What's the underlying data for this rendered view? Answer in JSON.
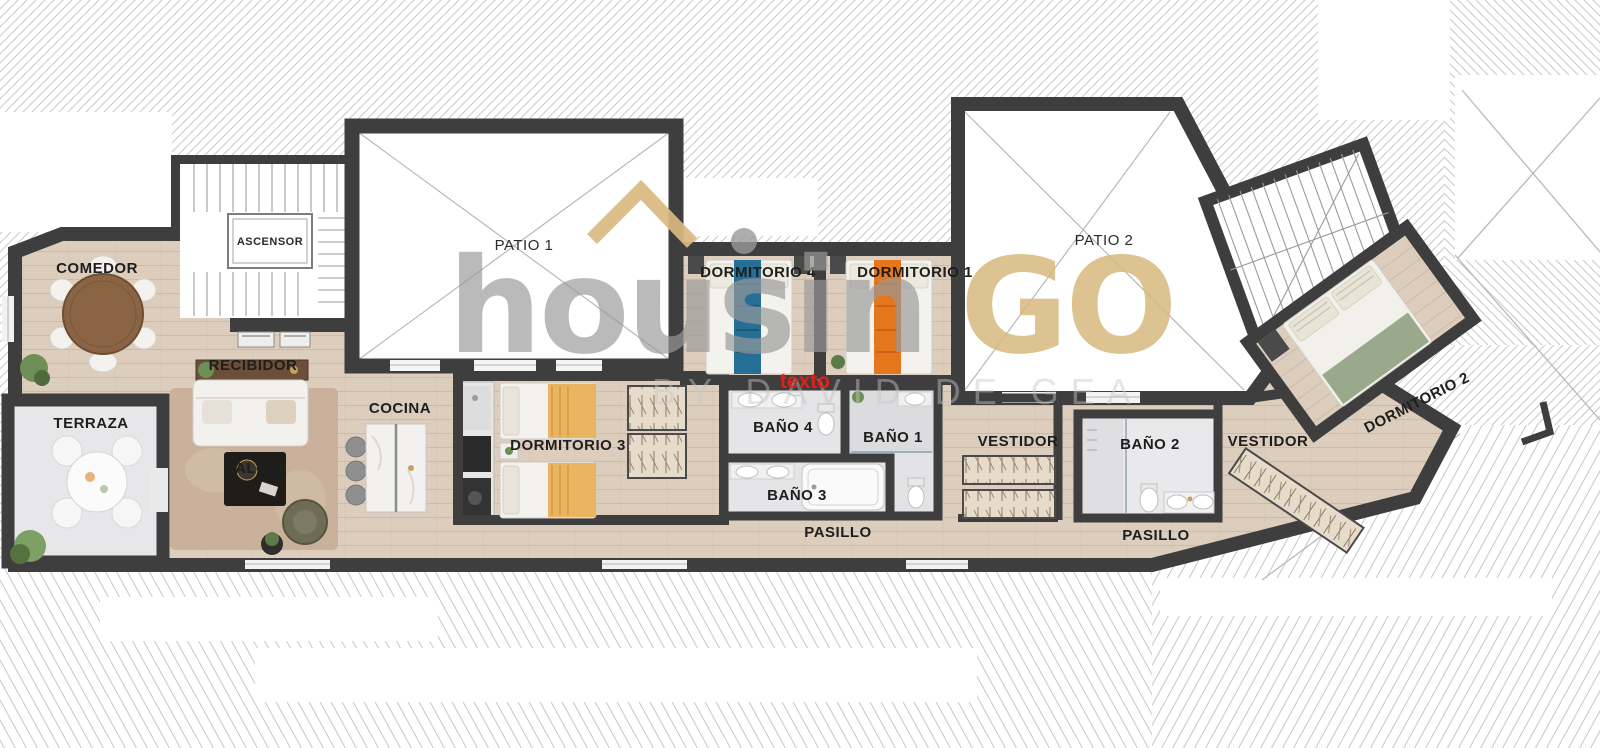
{
  "watermark": {
    "brand_gray": "housin",
    "brand_gold": "GO",
    "tagline": "BY DAVID DE GEA",
    "placeholder": "texto",
    "roof_icon": "gold house-roof chevron with gray dot"
  },
  "colors": {
    "brand_gold": "#d8b87f",
    "brand_gray": "#9a9a9a",
    "tagline_gray": "#c6c6c6",
    "placeholder_red": "#e5211a",
    "wall_dark": "#3e3e3e",
    "wood_floor": "#dccdbc",
    "terrace_floor": "#e7e7e9",
    "bath_floor": "#e5e5e7",
    "accent_blue": "#256e96",
    "accent_orange": "#e4761c",
    "accent_sage": "#9aa98c"
  },
  "rooms": {
    "comedor": "COMEDOR",
    "ascensor": "ASCENSOR",
    "patio_1": "PATIO 1",
    "dormitorio_4": "DORMITORIO 4",
    "dormitorio_1": "DORMITORIO 1",
    "patio_2": "PATIO 2",
    "recibidor": "RECIBIDOR",
    "terraza": "TERRAZA",
    "salon": "SALÓN",
    "cocina": "COCINA",
    "dormitorio_3": "DORMITORIO 3",
    "bano_4": "BAÑO 4",
    "bano_1": "BAÑO 1",
    "bano_3": "BAÑO 3",
    "pasillo_1": "PASILLO",
    "vestidor_1": "VESTIDOR",
    "bano_2": "BAÑO 2",
    "vestidor_2": "VESTIDOR",
    "pasillo_2": "PASILLO",
    "dormitorio_2": "DORMITORIO 2"
  }
}
